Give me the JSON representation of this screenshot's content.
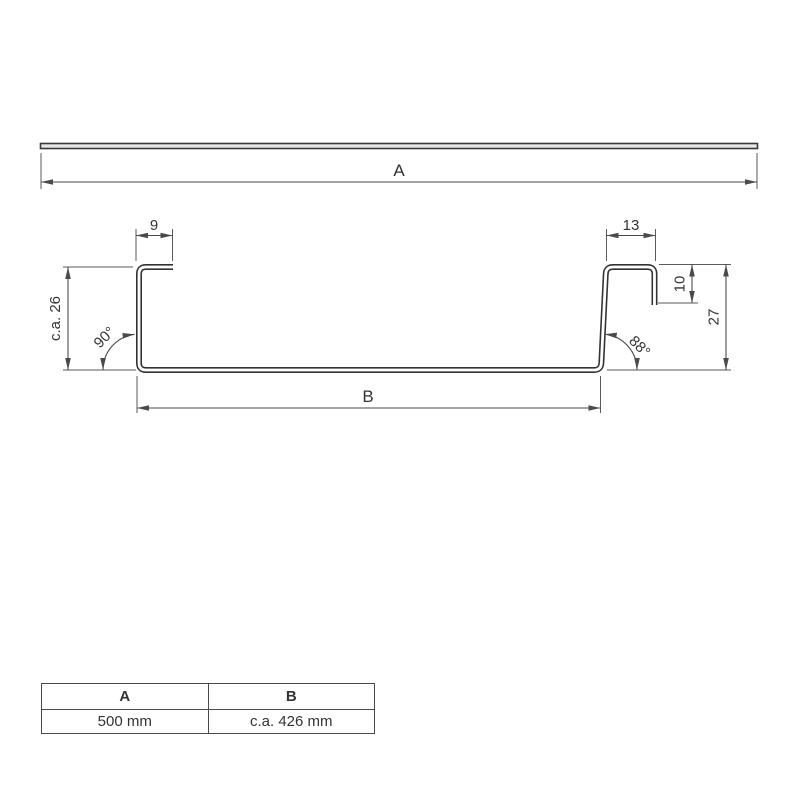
{
  "colors": {
    "line": "#4a4a4a",
    "profile": "#333333",
    "text": "#333333",
    "sheet_fill": "#e8e8e8",
    "background": "#ffffff"
  },
  "top_view": {
    "dim_width_label": "A"
  },
  "profile": {
    "dim_top_left_flange": "9",
    "dim_top_right_flange": "13",
    "dim_left_height": "c.a. 26",
    "angle_bottom_left": "90°",
    "angle_bottom_right": "88°",
    "dim_right_lip": "10",
    "dim_right_height": "27",
    "dim_inner_width_label": "B"
  },
  "dimensions_table": {
    "headers": [
      "A",
      "B"
    ],
    "values": [
      "500 mm",
      "c.a. 426 mm"
    ]
  }
}
